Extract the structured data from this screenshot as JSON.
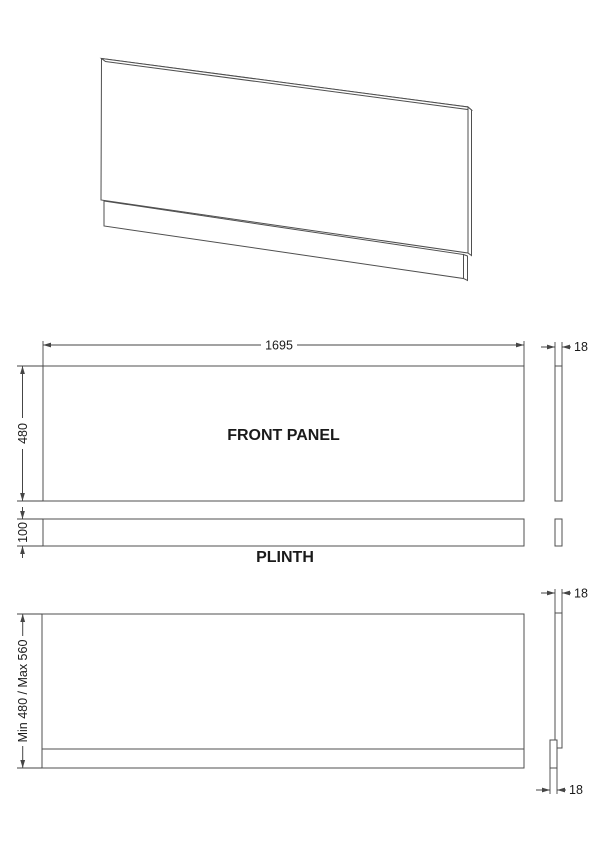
{
  "drawing": {
    "front_panel": {
      "label": "FRONT PANEL",
      "width": "1695",
      "height": "480",
      "thickness": "18"
    },
    "plinth": {
      "label": "PLINTH",
      "height": "100"
    },
    "assembled": {
      "height_range": "Min 480 / Max 560",
      "panel_thickness": "18",
      "plinth_thickness": "18"
    },
    "colors": {
      "line": "#4f4f4f",
      "dimension": "#454545",
      "text": "#1a1a1a",
      "background": "#ffffff"
    }
  }
}
